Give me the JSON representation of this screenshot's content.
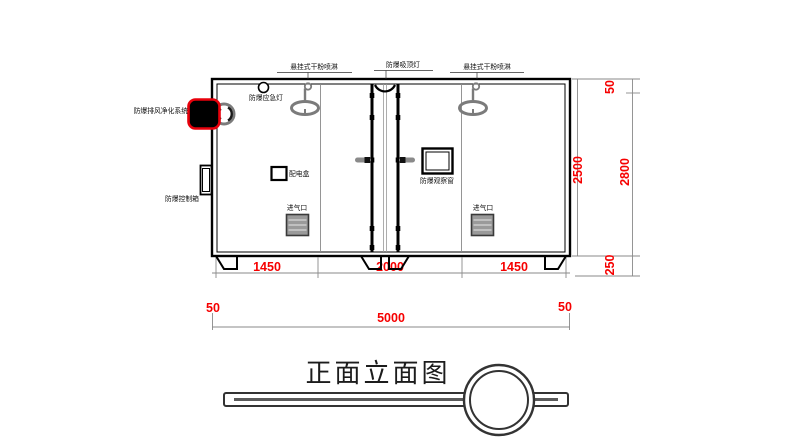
{
  "drawing": {
    "title": "正面立面图",
    "labels": {
      "sprinkler_left": "悬挂式干粉喷淋",
      "ceiling_light": "防爆吸顶灯",
      "sprinkler_right": "悬挂式干粉喷淋",
      "emergency_light": "防爆应急灯",
      "purification_system": "防爆排风净化系统",
      "control_box": "防爆控制箱",
      "power_box": "配电盒",
      "observation_window": "防爆观察窗",
      "air_inlet_left": "进气口",
      "air_inlet_right": "进气口"
    },
    "dimensions": {
      "bottom_segments": [
        "1450",
        "2000",
        "1450"
      ],
      "wall_left": "50",
      "overall_width": "5000",
      "wall_right": "50",
      "inner_height": "2500",
      "roof": "50",
      "overall_height": "2800",
      "base": "250"
    },
    "colors": {
      "dimension_text": "#f60000",
      "highlight": "#e8000b",
      "line": "#000000",
      "gray_fixture": "#7b7b7b"
    }
  }
}
